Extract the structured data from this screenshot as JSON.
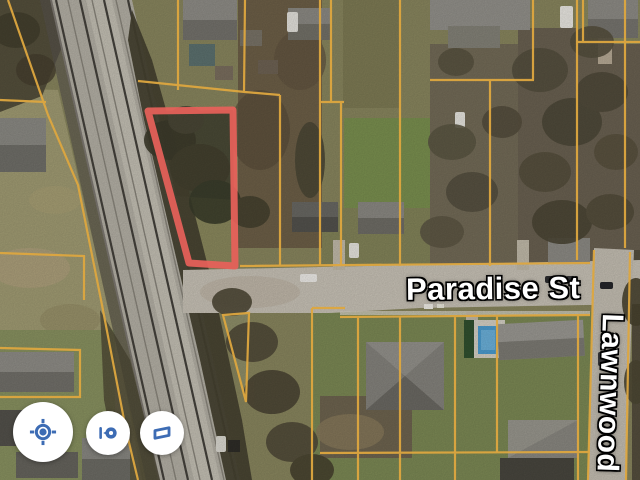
{
  "map_view": {
    "type": "satellite",
    "street_labels": [
      {
        "name": "Paradise St",
        "orientation": "horizontal"
      },
      {
        "name": "Lawnwood",
        "orientation": "vertical"
      }
    ],
    "highlighted_parcel": {
      "outline_color": "#e8615a"
    },
    "parcel_line_color": "#dda63f"
  },
  "controls": {
    "my_location": {
      "icon": "my-location-icon"
    },
    "street_view": {
      "icon": "street-view-pin-icon"
    },
    "map_toggle": {
      "icon": "map-tilt-icon"
    }
  },
  "colors": {
    "control_icon": "#3d6cb4",
    "control_background": "#ffffff",
    "label_text": "#ffffff",
    "label_halo": "#000000"
  }
}
